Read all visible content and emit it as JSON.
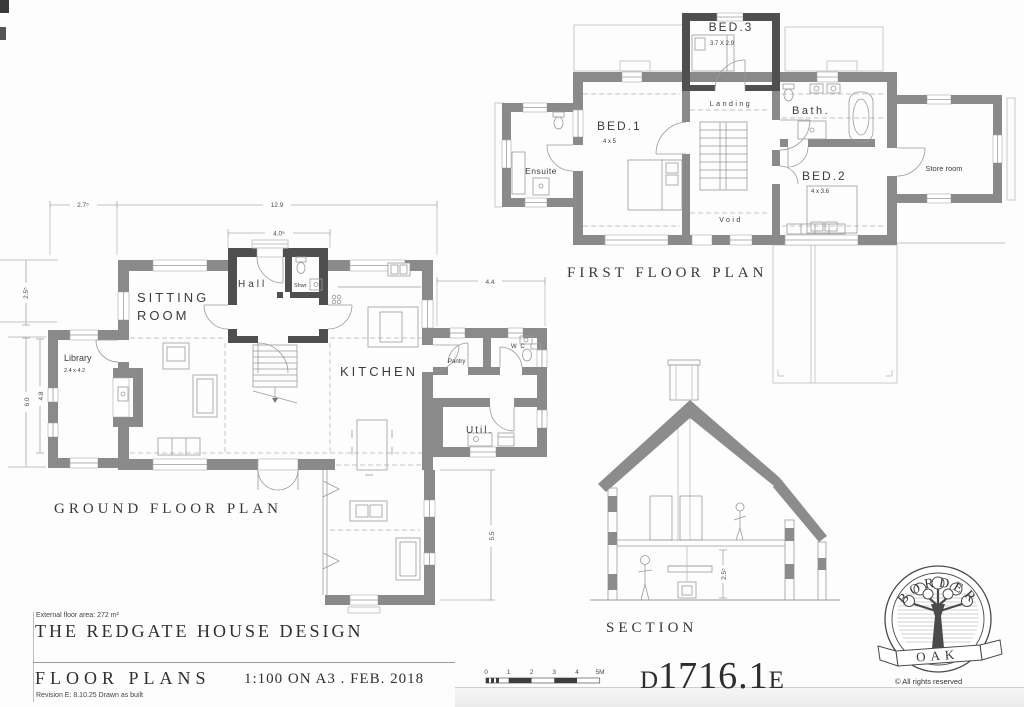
{
  "first_floor": {
    "label": "FIRST FLOOR PLAN",
    "bed1": "BED.1",
    "bed1_dims": "4 x 5",
    "bed2": "BED.2",
    "bed2_dims": "4 x 3.6",
    "bed3": "BED.3",
    "bed3_dims": "3.7 X 2.9",
    "landing": "Landing",
    "bath": "Bath.",
    "ensuite": "Ensuite",
    "store": "Store room",
    "void": "Void"
  },
  "ground_floor": {
    "label": "GROUND FLOOR PLAN",
    "sitting_1": "SITTING",
    "sitting_2": "ROOM",
    "hall": "Hall",
    "shwr": "Shwr.",
    "library": "Library",
    "library_dims": "2.4 x 4.2",
    "kitchen": "KITCHEN",
    "pantry": "Pantry",
    "wc": "W C",
    "util": "Util.",
    "dim_top_left": "2.7⁵",
    "dim_top": "12.9",
    "dim_hall": "4.0⁵",
    "dim_left_upper": "2.5⁵",
    "dim_left_outer": "6.0",
    "dim_left_inner": "4.8",
    "dim_right_top": "4.4",
    "dim_right_bottom": "5.5"
  },
  "section": {
    "label": "SECTION",
    "dim_height": "2.5⁵"
  },
  "title_block": {
    "area_note": "External floor area: 272 m²",
    "title": "THE REDGATE HOUSE DESIGN",
    "drawing_name": "FLOOR PLANS",
    "scale_note": "1:100 ON A3  .  FEB. 2018",
    "revision": "Revision E: 8.10.25 Drawn as built"
  },
  "drawing_number": {
    "prefix": "D",
    "number": "1716.1",
    "suffix": "E"
  },
  "scale_bar": {
    "ticks": [
      "0",
      "1",
      "2",
      "3",
      "4",
      "5M"
    ]
  },
  "logo": {
    "arc": "BORDER",
    "banner": "OAK",
    "rights": "© All rights reserved"
  },
  "colors": {
    "wall": "#8a8a8a",
    "wall_dark": "#4f4f4f",
    "roof_fill": "#8c8c8c",
    "label_text": "#3d3d3d"
  }
}
